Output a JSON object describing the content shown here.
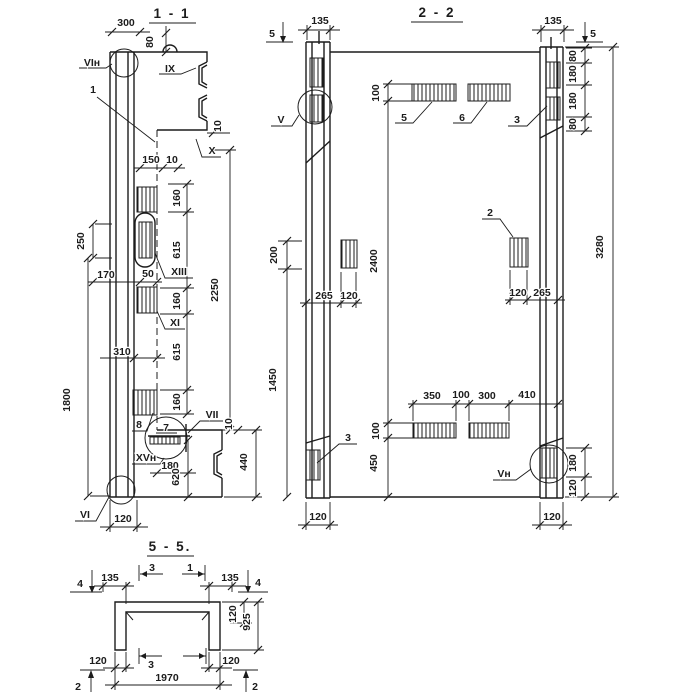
{
  "page": {
    "background": "#ffffff",
    "ink": "#1c1c1c"
  },
  "s1": {
    "title": "1 - 1",
    "labels": {
      "vin": "VIн",
      "pos1": "1",
      "ix": "IX",
      "x": "X",
      "xiii": "XIII",
      "xi": "XI",
      "pos8": "8",
      "pos7": "7",
      "vii": "VII",
      "xvn": "XVн",
      "vi": "VI"
    },
    "dims": {
      "d300": "300",
      "d80": "80",
      "d150": "150",
      "d10a": "10",
      "d10b": "10",
      "d10c": "10",
      "d160a": "160",
      "d615a": "615",
      "d160b": "160",
      "d615b": "615",
      "d160c": "160",
      "d2250": "2250",
      "d250": "250",
      "d170": "170",
      "d50": "50",
      "d310": "310",
      "d1800": "1800",
      "d180": "180",
      "d620": "620",
      "d440": "440",
      "d120": "120"
    }
  },
  "s2": {
    "title": "2 - 2",
    "labels": {
      "cut5l": "5",
      "cut5r": "5",
      "v": "V",
      "pos5": "5",
      "pos6": "6",
      "pos3r": "3",
      "pos2": "2",
      "pos3l": "3",
      "vn": "Vн"
    },
    "dims": {
      "d135l": "135",
      "d135r": "135",
      "d80a": "80",
      "d180a": "180",
      "d180b": "180",
      "d80b": "80",
      "d100t": "100",
      "d2400": "2400",
      "d3280": "3280",
      "d200": "200",
      "d1450": "1450",
      "d265l": "265",
      "d120l": "120",
      "d120r": "120",
      "d265r": "265",
      "d350": "350",
      "d100m": "100",
      "d300": "300",
      "d410": "410",
      "d100b": "100",
      "d450": "450",
      "d180c": "180",
      "d120c": "120",
      "d120bl": "120",
      "d120br": "120"
    }
  },
  "s5": {
    "title": "5 - 5.",
    "labels": {
      "cut4l": "4",
      "cut4r": "4",
      "cut3t": "3",
      "cut1t": "1",
      "cut3b": "3",
      "cut2l": "2",
      "cut2r": "2"
    },
    "dims": {
      "d135l": "135",
      "d135r": "135",
      "d120t": "120",
      "d925": "925",
      "d120bl": "120",
      "d120br": "120",
      "d1970": "1970"
    }
  }
}
